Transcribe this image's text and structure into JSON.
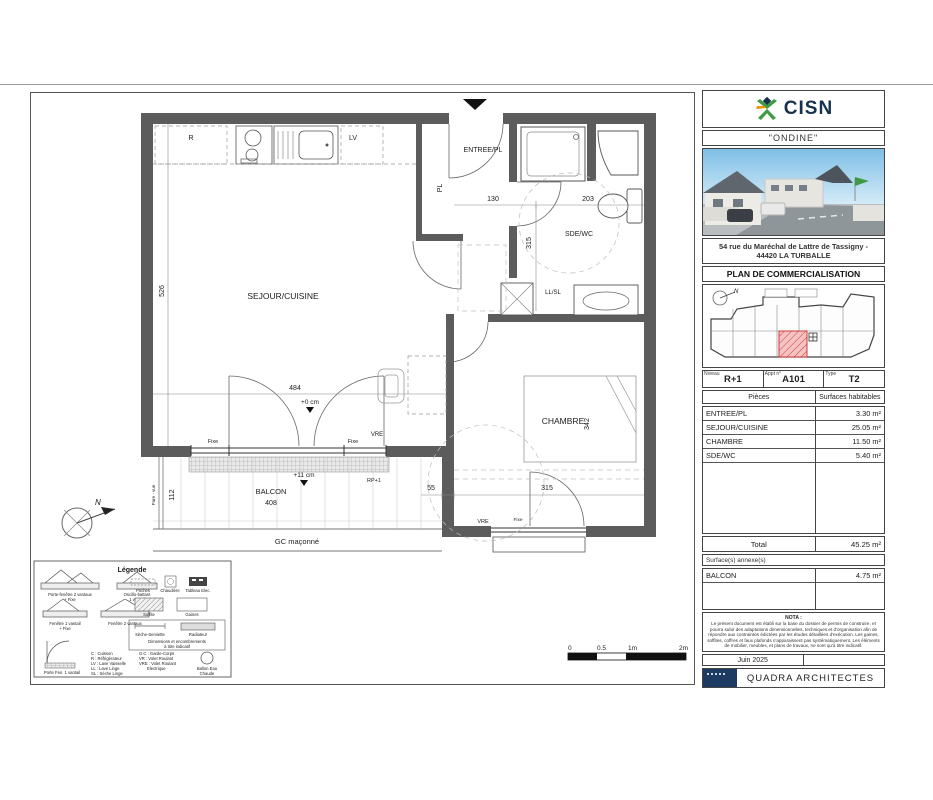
{
  "plan": {
    "rooms": {
      "sejour": "SEJOUR/CUISINE",
      "entree": "ENTREE/PL",
      "sde": "SDE/WC",
      "chambre": "CHAMBRE",
      "balcon": "BALCON",
      "placard": "PL"
    },
    "fixtures": {
      "fridge": "R",
      "dishwasher": "LV",
      "washer": "LL/SL"
    },
    "levels": {
      "sejour": "+0 cm",
      "balcon": "+11 cm"
    },
    "dims": {
      "sejour_w": "484",
      "sejour_v": "526",
      "entree_w": "130",
      "sde_w": "203",
      "sde_v": "315",
      "chambre_v": "342",
      "chambre_w": "315",
      "step": "55",
      "balcon_w": "408",
      "balcon_v": "112"
    },
    "window_labels": {
      "fixe_left": "Fixe",
      "fixe_right": "Fixe",
      "vre_sejour": "VRE",
      "vre_chambre": "VRE",
      "fixe_chambre": "Fixe",
      "rp": "RP+1",
      "pare_vue": "Pare - vue",
      "gc": "GC maçonné"
    },
    "north": "N",
    "scalebar": {
      "t0": "0",
      "t05": "0.5",
      "t1": "1m",
      "t2": "2m"
    }
  },
  "legend": {
    "title": "Légende",
    "windows": [
      {
        "l1": "Porte-fenêtre 2 vantaux",
        "l2": "+ Fixe"
      },
      {
        "l1": "Oscillo-battant",
        "l2": "1 vantail"
      },
      {
        "l1": "Fenêtre 1 vantail",
        "l2": "+ Fixe"
      },
      {
        "l1": "Fenêtre 2 vantaux",
        "l2": ""
      },
      {
        "l1": "Porte Fen. 1 vantail",
        "l2": ""
      }
    ],
    "symbols": {
      "poches": "Poches",
      "chaudiere": "Chaudière",
      "tableau": "Tableau Elec.",
      "soffite": "Soffite",
      "gaines": "Gaines",
      "seche": "Sèche-Serviette",
      "radiateur": "Radiateur"
    },
    "note": {
      "l1": "Dimensions et encombrements",
      "l2": "à titre indicatif"
    },
    "abbr_left": [
      "C : Cuisson",
      "R : Réfrigérateur",
      "LV : Lave Vaisselle",
      "LL : Lave Linge",
      "SL : Sèche Linge"
    ],
    "abbr_right": [
      "G.C : Garde-Corps",
      "VR : Volet Roulant",
      "VRE : Volet Roulant",
      "Electrique"
    ],
    "ballon": {
      "l1": "Ballon Eau",
      "l2": "Chaude"
    }
  },
  "panel": {
    "brand": "CISN",
    "project": "\"ONDINE\"",
    "address1": "54 rue du Maréchal de Lattre de Tassigny -",
    "address2": "44420 LA TURBALLE",
    "doc_title": "PLAN DE COMMERCIALISATION",
    "niveau_label": "Niveau",
    "niveau": "R+1",
    "appt_label": "Appt n°",
    "appt": "A101",
    "type_label": "Type",
    "type": "T2",
    "col_rooms": "Pièces",
    "col_surfaces": "Surfaces habitables",
    "rows": [
      {
        "name": "ENTREE/PL",
        "area": "3.30 m²"
      },
      {
        "name": "SEJOUR/CUISINE",
        "area": "25.05 m²"
      },
      {
        "name": "CHAMBRE",
        "area": "11.50 m²"
      },
      {
        "name": "SDE/WC",
        "area": "5.40 m²"
      }
    ],
    "total_label": "Total",
    "total": "45.25 m²",
    "annex_label": "Surface(s) annexe(s)",
    "annex_rows": [
      {
        "name": "BALCON",
        "area": "4.75 m²"
      }
    ],
    "nota_title": "NOTA :",
    "nota_text": "Le présent document est établi sur la base du dossier de permis de construire, et pourra subir des adaptations dimensionnelles, techniques et d'organisation afin de répondre aux contraintes édictées par les études détaillées d'exécution. Les gaines, soffites, coffres et faux plafonds n'apparaissent pas systématiquement. Les éléments de mobilier, meubles, et plans de travaux, ne sont qu'à titre indicatif.",
    "date": "Juin 2025",
    "firm": "QUADRA ARCHITECTES"
  },
  "colors": {
    "wall": "#5c5c5c",
    "unit_red": "#cc3b3b",
    "navy": "#16324f",
    "green": "#3f9b43",
    "orange": "#f29200"
  }
}
